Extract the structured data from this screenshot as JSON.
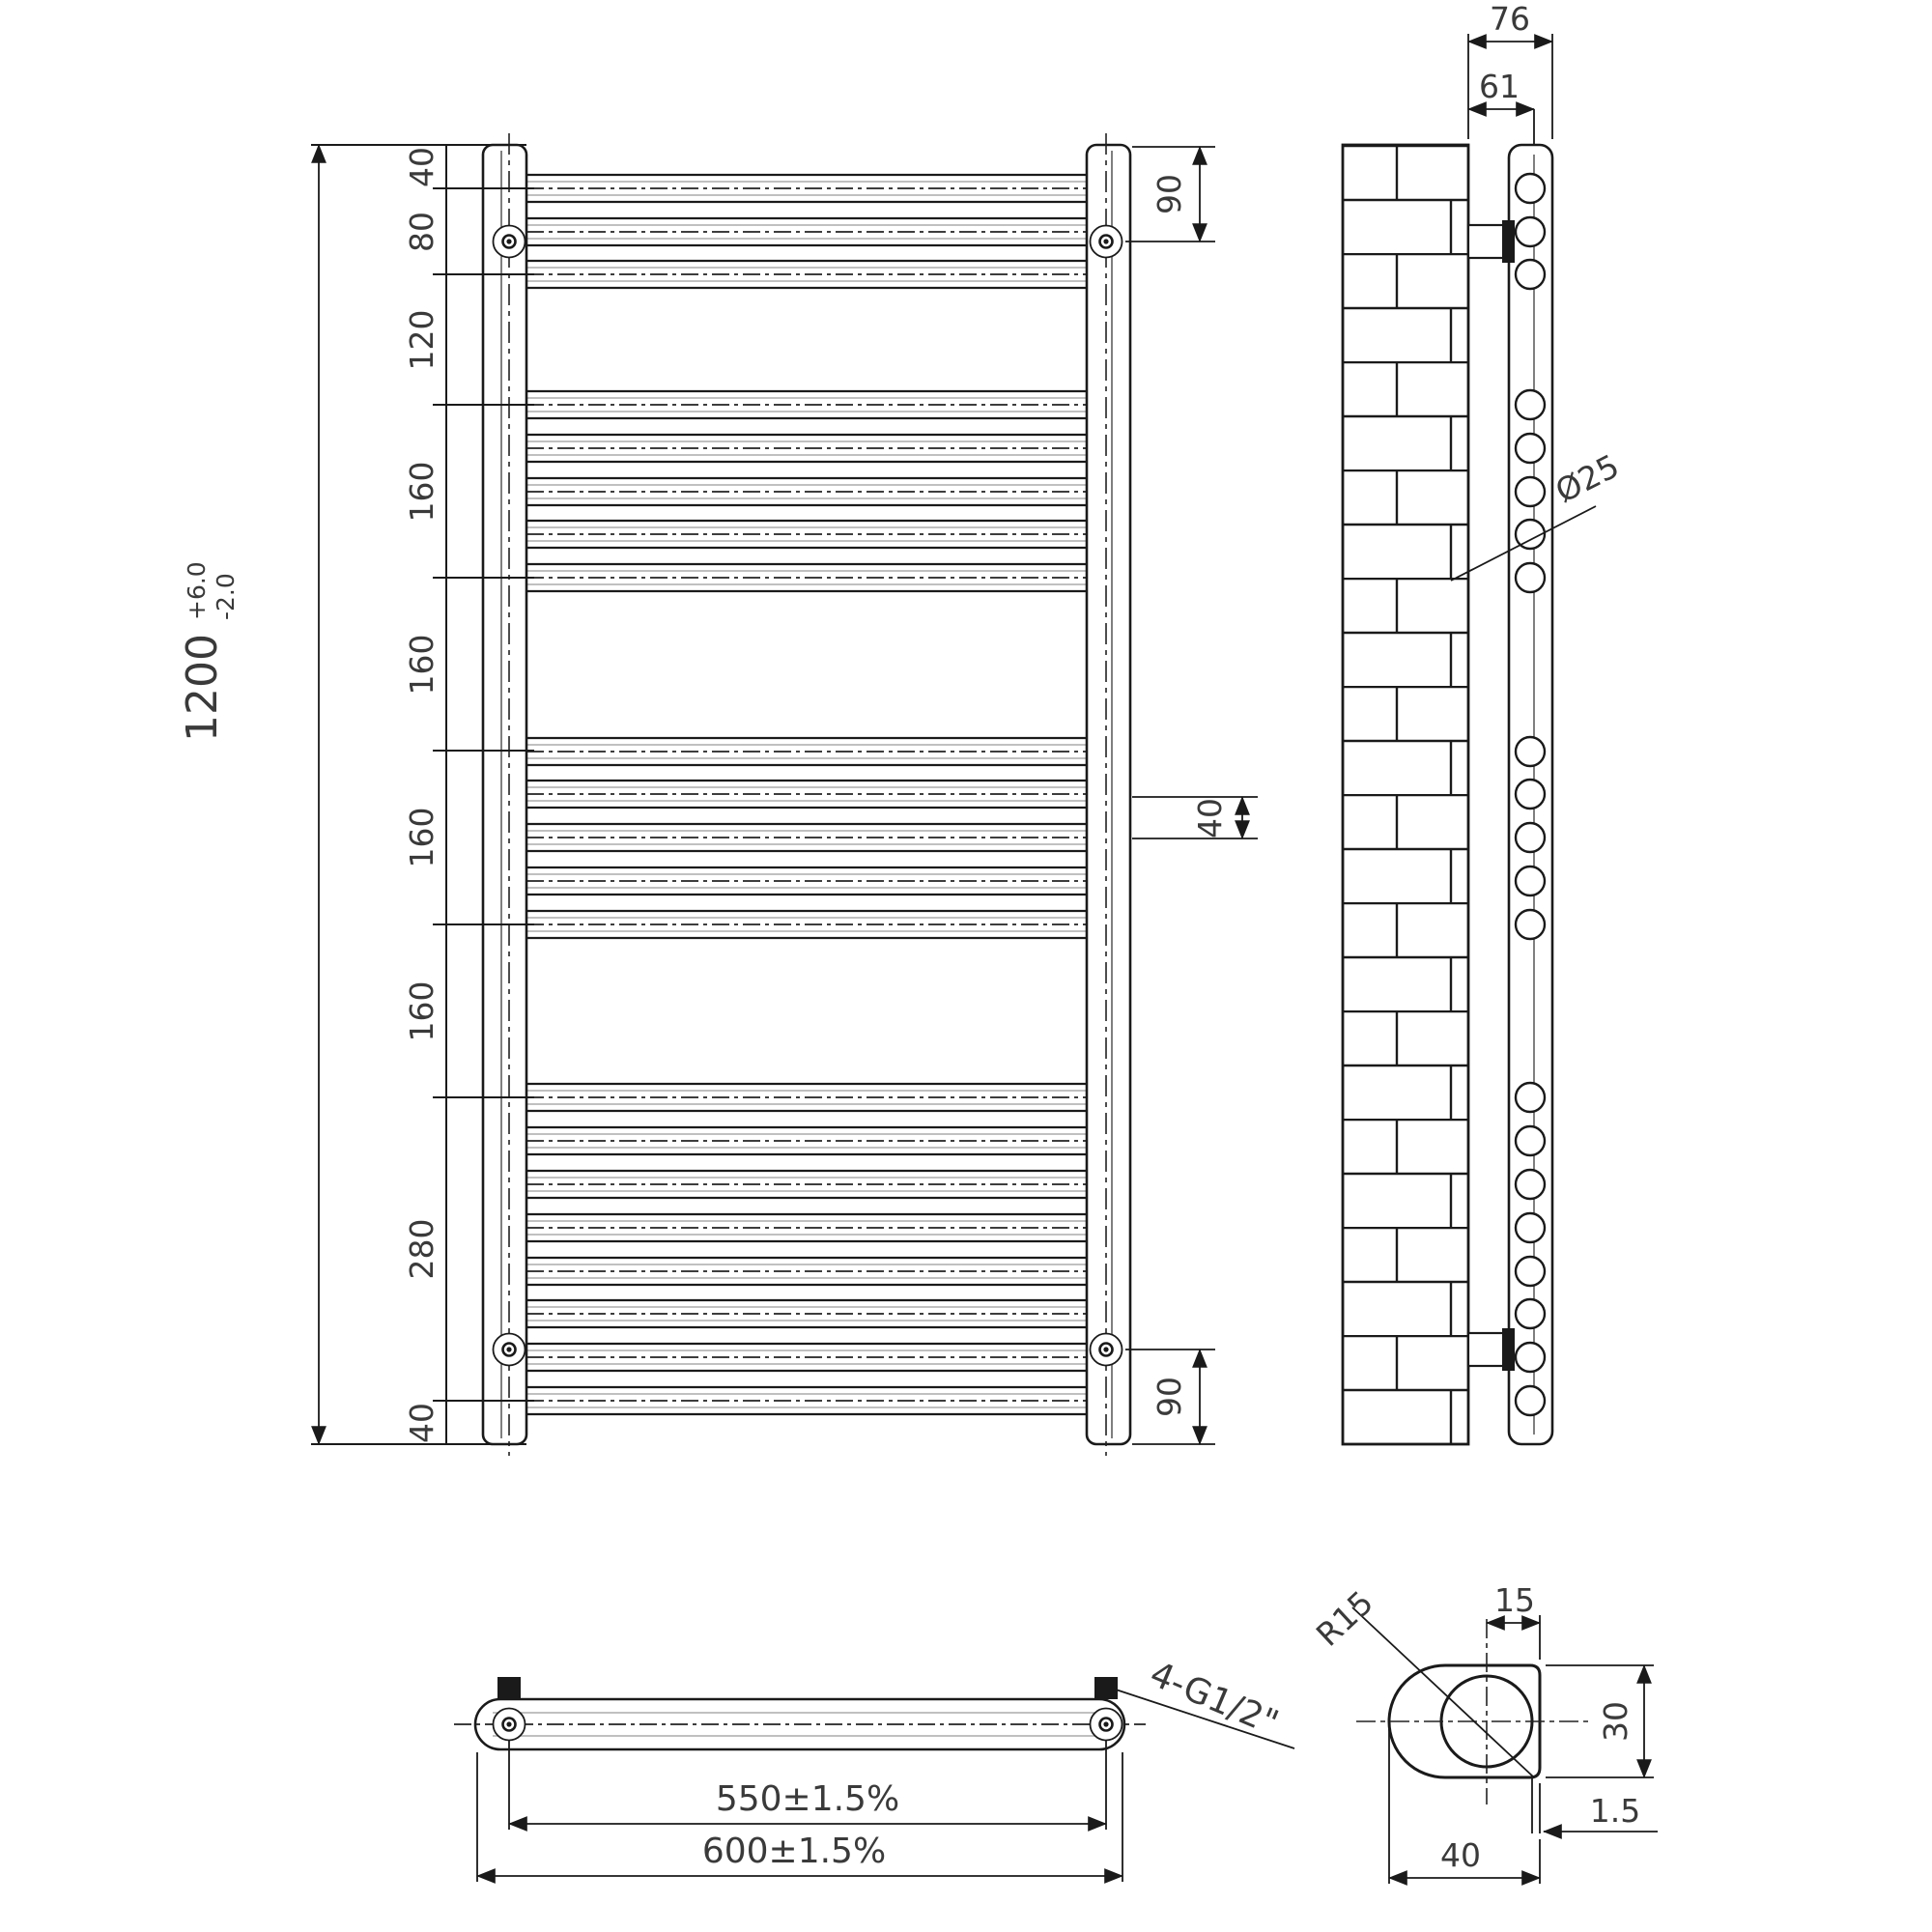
{
  "drawing": {
    "front": {
      "overall": "1200",
      "tol_plus": "+6.0",
      "tol_minus": "-2.0",
      "chain": [
        "40",
        "80",
        "120",
        "160",
        "160",
        "160",
        "160",
        "280",
        "40"
      ],
      "dim_90_top": "90",
      "dim_40_mid": "40",
      "dim_90_bottom": "90"
    },
    "side": {
      "dim_76": "76",
      "dim_61": "61",
      "tube_dia": "Ø25"
    },
    "plan": {
      "dim_centres": "550±1.5%",
      "dim_overall": "600±1.5%",
      "thread_label": "4-G1/2\""
    },
    "section": {
      "radius": "R15",
      "dim_15": "15",
      "dim_30": "30",
      "dim_wall": "1.5",
      "dim_40": "40"
    }
  }
}
